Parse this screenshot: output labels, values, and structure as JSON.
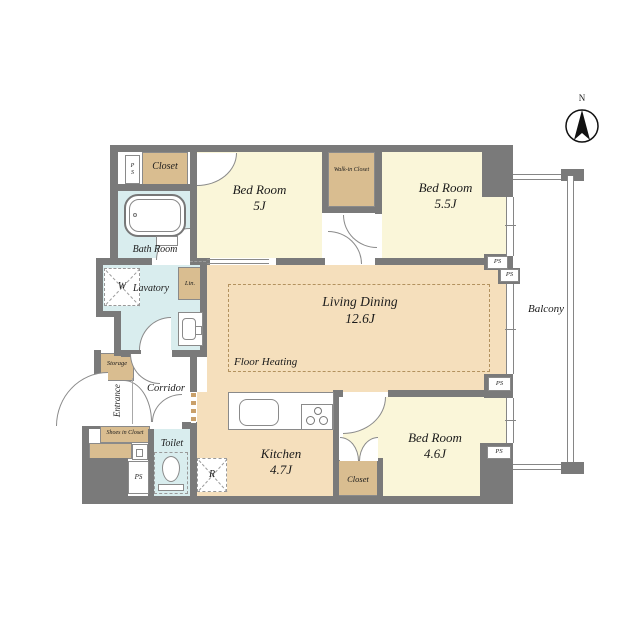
{
  "meta": {
    "type": "apartment-floor-plan"
  },
  "colors": {
    "wall": "#7a7a7a",
    "bedroom_floor": "#faf6d9",
    "living_floor": "#f5dfbc",
    "closet_fill": "#d9bd90",
    "wet_area_fill": "#d9edee",
    "floor_heating_dash": "#b3925f"
  },
  "compass": {
    "north_label": "N"
  },
  "balcony": {
    "label": "Balcony"
  },
  "rooms": {
    "bedroom_5j": {
      "name": "Bed Room",
      "size": "5J"
    },
    "bedroom_55j": {
      "name": "Bed Room",
      "size": "5.5J"
    },
    "bedroom_46j": {
      "name": "Bed Room",
      "size": "4.6J"
    },
    "living_dining": {
      "name": "Living Dining",
      "size": "12.6J",
      "note": "Floor Heating"
    },
    "kitchen": {
      "name": "Kitchen",
      "size": "4.7J"
    },
    "bath": {
      "name": "Bath Room"
    },
    "lavatory": {
      "name": "Lavatory"
    },
    "toilet": {
      "name": "Toilet"
    },
    "corridor": {
      "name": "Corridor"
    },
    "entrance": {
      "name": "Entrance"
    },
    "storage": {
      "name": "Storage"
    },
    "shoes_closet": {
      "name": "Shoes in Closet"
    },
    "closet_north": {
      "name": "Closet"
    },
    "closet_south": {
      "name": "Closet"
    },
    "walk_in_closet": {
      "name": "Walk-in Closet"
    },
    "linen": {
      "name": "Lin."
    }
  },
  "fixtures": {
    "washer_label": "W",
    "fridge_label": "R"
  },
  "shafts": {
    "ps_top_left": "PS",
    "ps_bottom_left": "PS",
    "ps_right_1": "PS",
    "ps_right_2": "PS",
    "ps_right_3": "PS",
    "ps_right_4": "PS"
  }
}
